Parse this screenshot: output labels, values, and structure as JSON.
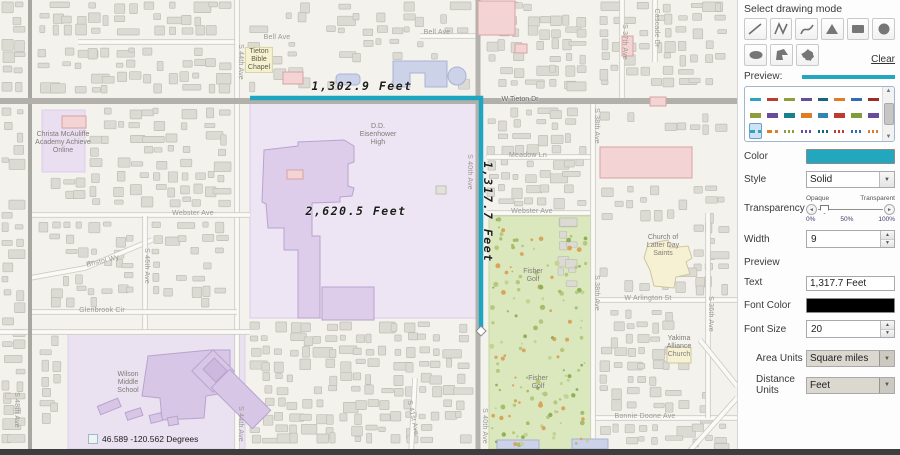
{
  "panel": {
    "title": "Select drawing mode",
    "clear_label": "Clear",
    "preview_label": "Preview:",
    "tools": [
      "line",
      "polyline",
      "freehand-line",
      "triangle",
      "rectangle",
      "circle",
      "ellipse",
      "polygon",
      "freehand-polygon"
    ],
    "colors": {
      "accent": "#22A7BE",
      "font_color": "#000000"
    },
    "palette": {
      "rows": [
        [
          {
            "c": "#2BA7BD",
            "w": 3
          },
          {
            "c": "#BE3B2F",
            "w": 3
          },
          {
            "c": "#8E9E3C",
            "w": 3
          },
          {
            "c": "#6A4C9C",
            "w": 3
          },
          {
            "c": "#19647E",
            "w": 3
          },
          {
            "c": "#E07B26",
            "w": 3
          },
          {
            "c": "#2F6EB5",
            "w": 3
          },
          {
            "c": "#9E2B25",
            "w": 3
          }
        ],
        [
          {
            "c": "#8E9E3C",
            "w": 5
          },
          {
            "c": "#6A4C9C",
            "w": 5
          },
          {
            "c": "#19818E",
            "w": 5
          },
          {
            "c": "#E07B26",
            "w": 5
          },
          {
            "c": "#2F86B5",
            "w": 5
          },
          {
            "c": "#BE3B2F",
            "w": 5
          },
          {
            "c": "#7E9E3C",
            "w": 5
          },
          {
            "c": "#6A4C9C",
            "w": 5
          }
        ],
        [
          {
            "c": "#2BA7BD",
            "w": 3,
            "dash": "long",
            "sel": true
          },
          {
            "c": "#E07B26",
            "w": 3,
            "dash": "long"
          },
          {
            "c": "#8E9E3C",
            "w": 3,
            "dash": "short"
          },
          {
            "c": "#6A4C9C",
            "w": 3,
            "dash": "short"
          },
          {
            "c": "#19647E",
            "w": 3,
            "dash": "short"
          },
          {
            "c": "#BE3B2F",
            "w": 3,
            "dash": "short"
          },
          {
            "c": "#2F6EB5",
            "w": 3,
            "dash": "short"
          },
          {
            "c": "#E07B26",
            "w": 3,
            "dash": "short"
          }
        ]
      ]
    },
    "fields": {
      "color_label": "Color",
      "style_label": "Style",
      "style_value": "Solid",
      "transparency_label": "Transparency",
      "opaque_label": "Opaque",
      "transparent_label": "Transparent",
      "tick_0": "0%",
      "tick_50": "50%",
      "tick_100": "100%",
      "width_label": "Width",
      "width_value": "9",
      "preview_label": "Preview",
      "text_label": "Text",
      "text_value": "1,317.7 Feet",
      "font_color_label": "Font Color",
      "font_size_label": "Font Size",
      "font_size_value": "20",
      "area_units_label": "Area Units",
      "area_units_value": "Square miles",
      "distance_units_label": "Distance Units",
      "distance_units_value": "Feet"
    }
  },
  "map": {
    "measurements": {
      "top": "1,302.9 Feet",
      "middle": "2,620.5 Feet",
      "right": "1,317.7 Feet"
    },
    "coordinates": "46.589 -120.562 Degrees",
    "labels": [
      {
        "text": "Bell Ave",
        "x": 277,
        "y": 38,
        "cls": "street"
      },
      {
        "text": "Bell Ave",
        "x": 437,
        "y": 33,
        "cls": "street"
      },
      {
        "text": "W Tieton Dr",
        "x": 520,
        "y": 100,
        "cls": "street-on-road"
      },
      {
        "text": "Meadow Ln",
        "x": 528,
        "y": 156,
        "cls": "street"
      },
      {
        "text": "Webster Ave",
        "x": 193,
        "y": 214,
        "cls": "street"
      },
      {
        "text": "Webster Ave",
        "x": 532,
        "y": 212,
        "cls": "street"
      },
      {
        "text": "Bristol Wy",
        "x": 103,
        "y": 262,
        "rot": -14,
        "cls": "street"
      },
      {
        "text": "Glenbrook Cir",
        "x": 102,
        "y": 311,
        "cls": "street"
      },
      {
        "text": "W Arlington St",
        "x": 648,
        "y": 299,
        "cls": "street"
      },
      {
        "text": "Bonnie Doone Ave",
        "x": 645,
        "y": 417,
        "cls": "street"
      },
      {
        "text": "S 44th Ave",
        "x": 240,
        "y": 62,
        "rot": 90,
        "cls": "street-v"
      },
      {
        "text": "S 44th Ave",
        "x": 240,
        "y": 424,
        "rot": 90,
        "cls": "street-v"
      },
      {
        "text": "S 48th Ave",
        "x": 16,
        "y": 410,
        "rot": 90,
        "cls": "street-v"
      },
      {
        "text": "S 46th Ave",
        "x": 146,
        "y": 266,
        "rot": 90,
        "cls": "street-v"
      },
      {
        "text": "S 40th Ave",
        "x": 469,
        "y": 172,
        "rot": 90,
        "cls": "street-v"
      },
      {
        "text": "S 40th Ave",
        "x": 484,
        "y": 426,
        "rot": 90,
        "cls": "street-v"
      },
      {
        "text": "S 41st Ave",
        "x": 412,
        "y": 418,
        "rot": 78,
        "cls": "street-v"
      },
      {
        "text": "S 38th Ave",
        "x": 596,
        "y": 126,
        "rot": 90,
        "cls": "street-v"
      },
      {
        "text": "S 38th Ave",
        "x": 596,
        "y": 293,
        "rot": 90,
        "cls": "street-v"
      },
      {
        "text": "S 37th Ave",
        "x": 624,
        "y": 42,
        "rot": 90,
        "cls": "street-v"
      },
      {
        "text": "Cascade Dr",
        "x": 656,
        "y": 28,
        "rot": 90,
        "cls": "street-v"
      },
      {
        "text": "S 36th Ave",
        "x": 710,
        "y": 314,
        "rot": 90,
        "cls": "street-v"
      },
      {
        "text": "Tieton\nBible\nChapel",
        "x": 259,
        "y": 60,
        "cls": "poi-box"
      },
      {
        "text": "Christa McAuliffe\nAcademy Achieve\nOnline",
        "x": 63,
        "y": 143,
        "cls": "poi"
      },
      {
        "text": "D.D.\nEisenhower\nHigh",
        "x": 378,
        "y": 135,
        "cls": "poi"
      },
      {
        "text": "Wilson\nMiddle\nSchool",
        "x": 128,
        "y": 383,
        "cls": "poi"
      },
      {
        "text": "Fisher\nGolf",
        "x": 533,
        "y": 276,
        "cls": "poi"
      },
      {
        "text": "Fisher\nGolf",
        "x": 538,
        "y": 383,
        "cls": "poi"
      },
      {
        "text": "Church of\nLatter Day\nSaints",
        "x": 663,
        "y": 246,
        "cls": "poi"
      },
      {
        "text": "Yakima\nAlliance\nChurch",
        "x": 679,
        "y": 347,
        "cls": "poi"
      },
      {
        "text": "1,302.9 Feet",
        "x": 362,
        "y": 87,
        "cls": "measure"
      },
      {
        "text": "2,620.5 Feet",
        "x": 356,
        "y": 212,
        "cls": "measure"
      },
      {
        "text": "1,317.7 Feet",
        "x": 487,
        "y": 212,
        "rot": 90,
        "cls": "measure-v"
      }
    ]
  }
}
